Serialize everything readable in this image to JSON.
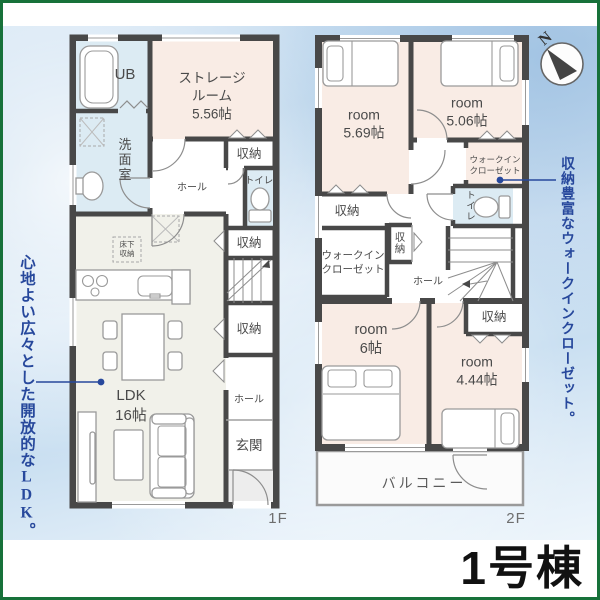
{
  "building": {
    "label": "1号棟"
  },
  "annotations": {
    "left": "心地よい広々とした開放的なLDK。",
    "right": "収納豊富なウォークインクローゼット。"
  },
  "compass": {
    "north": "N"
  },
  "f1": {
    "floor_label": "1F",
    "ub": "UB",
    "storage_1": "ストレージ",
    "storage_2": "ルーム",
    "storage_3": "5.56帖",
    "senmen": "洗面室",
    "hall_upper": "ホール",
    "toilet": "トイレ",
    "closet_a": "収納",
    "closet_b": "収納",
    "closet_c": "収納",
    "underfloor_1": "床下",
    "underfloor_2": "収納",
    "ldk_1": "LDK",
    "ldk_2": "16帖",
    "hall_lower": "ホール",
    "entrance": "玄関"
  },
  "f2": {
    "floor_label": "2F",
    "room_a_1": "room",
    "room_a_2": "5.69帖",
    "room_b_1": "room",
    "room_b_2": "5.06帖",
    "wic_right_1": "ウォークイン",
    "wic_right_2": "クローゼット",
    "toilet": "トイレ",
    "closet_tl": "収納",
    "wic_left_1": "ウォークイン",
    "wic_left_2": "クローゼット",
    "closet_mid": "収納",
    "hall": "ホール",
    "room_c_1": "room",
    "room_c_2": "6帖",
    "room_d_1": "room",
    "room_d_2": "4.44帖",
    "closet_br": "収納",
    "balcony": "バルコニー"
  },
  "colors": {
    "frame_green": "#17713a",
    "annotation_blue": "#27489c",
    "wall_gray": "#484848",
    "room_pink": "#f9ece5",
    "wet_blue": "#dcebf3",
    "ldk_beige": "#f1f1ea",
    "sky_blue": "#bed7ec"
  }
}
